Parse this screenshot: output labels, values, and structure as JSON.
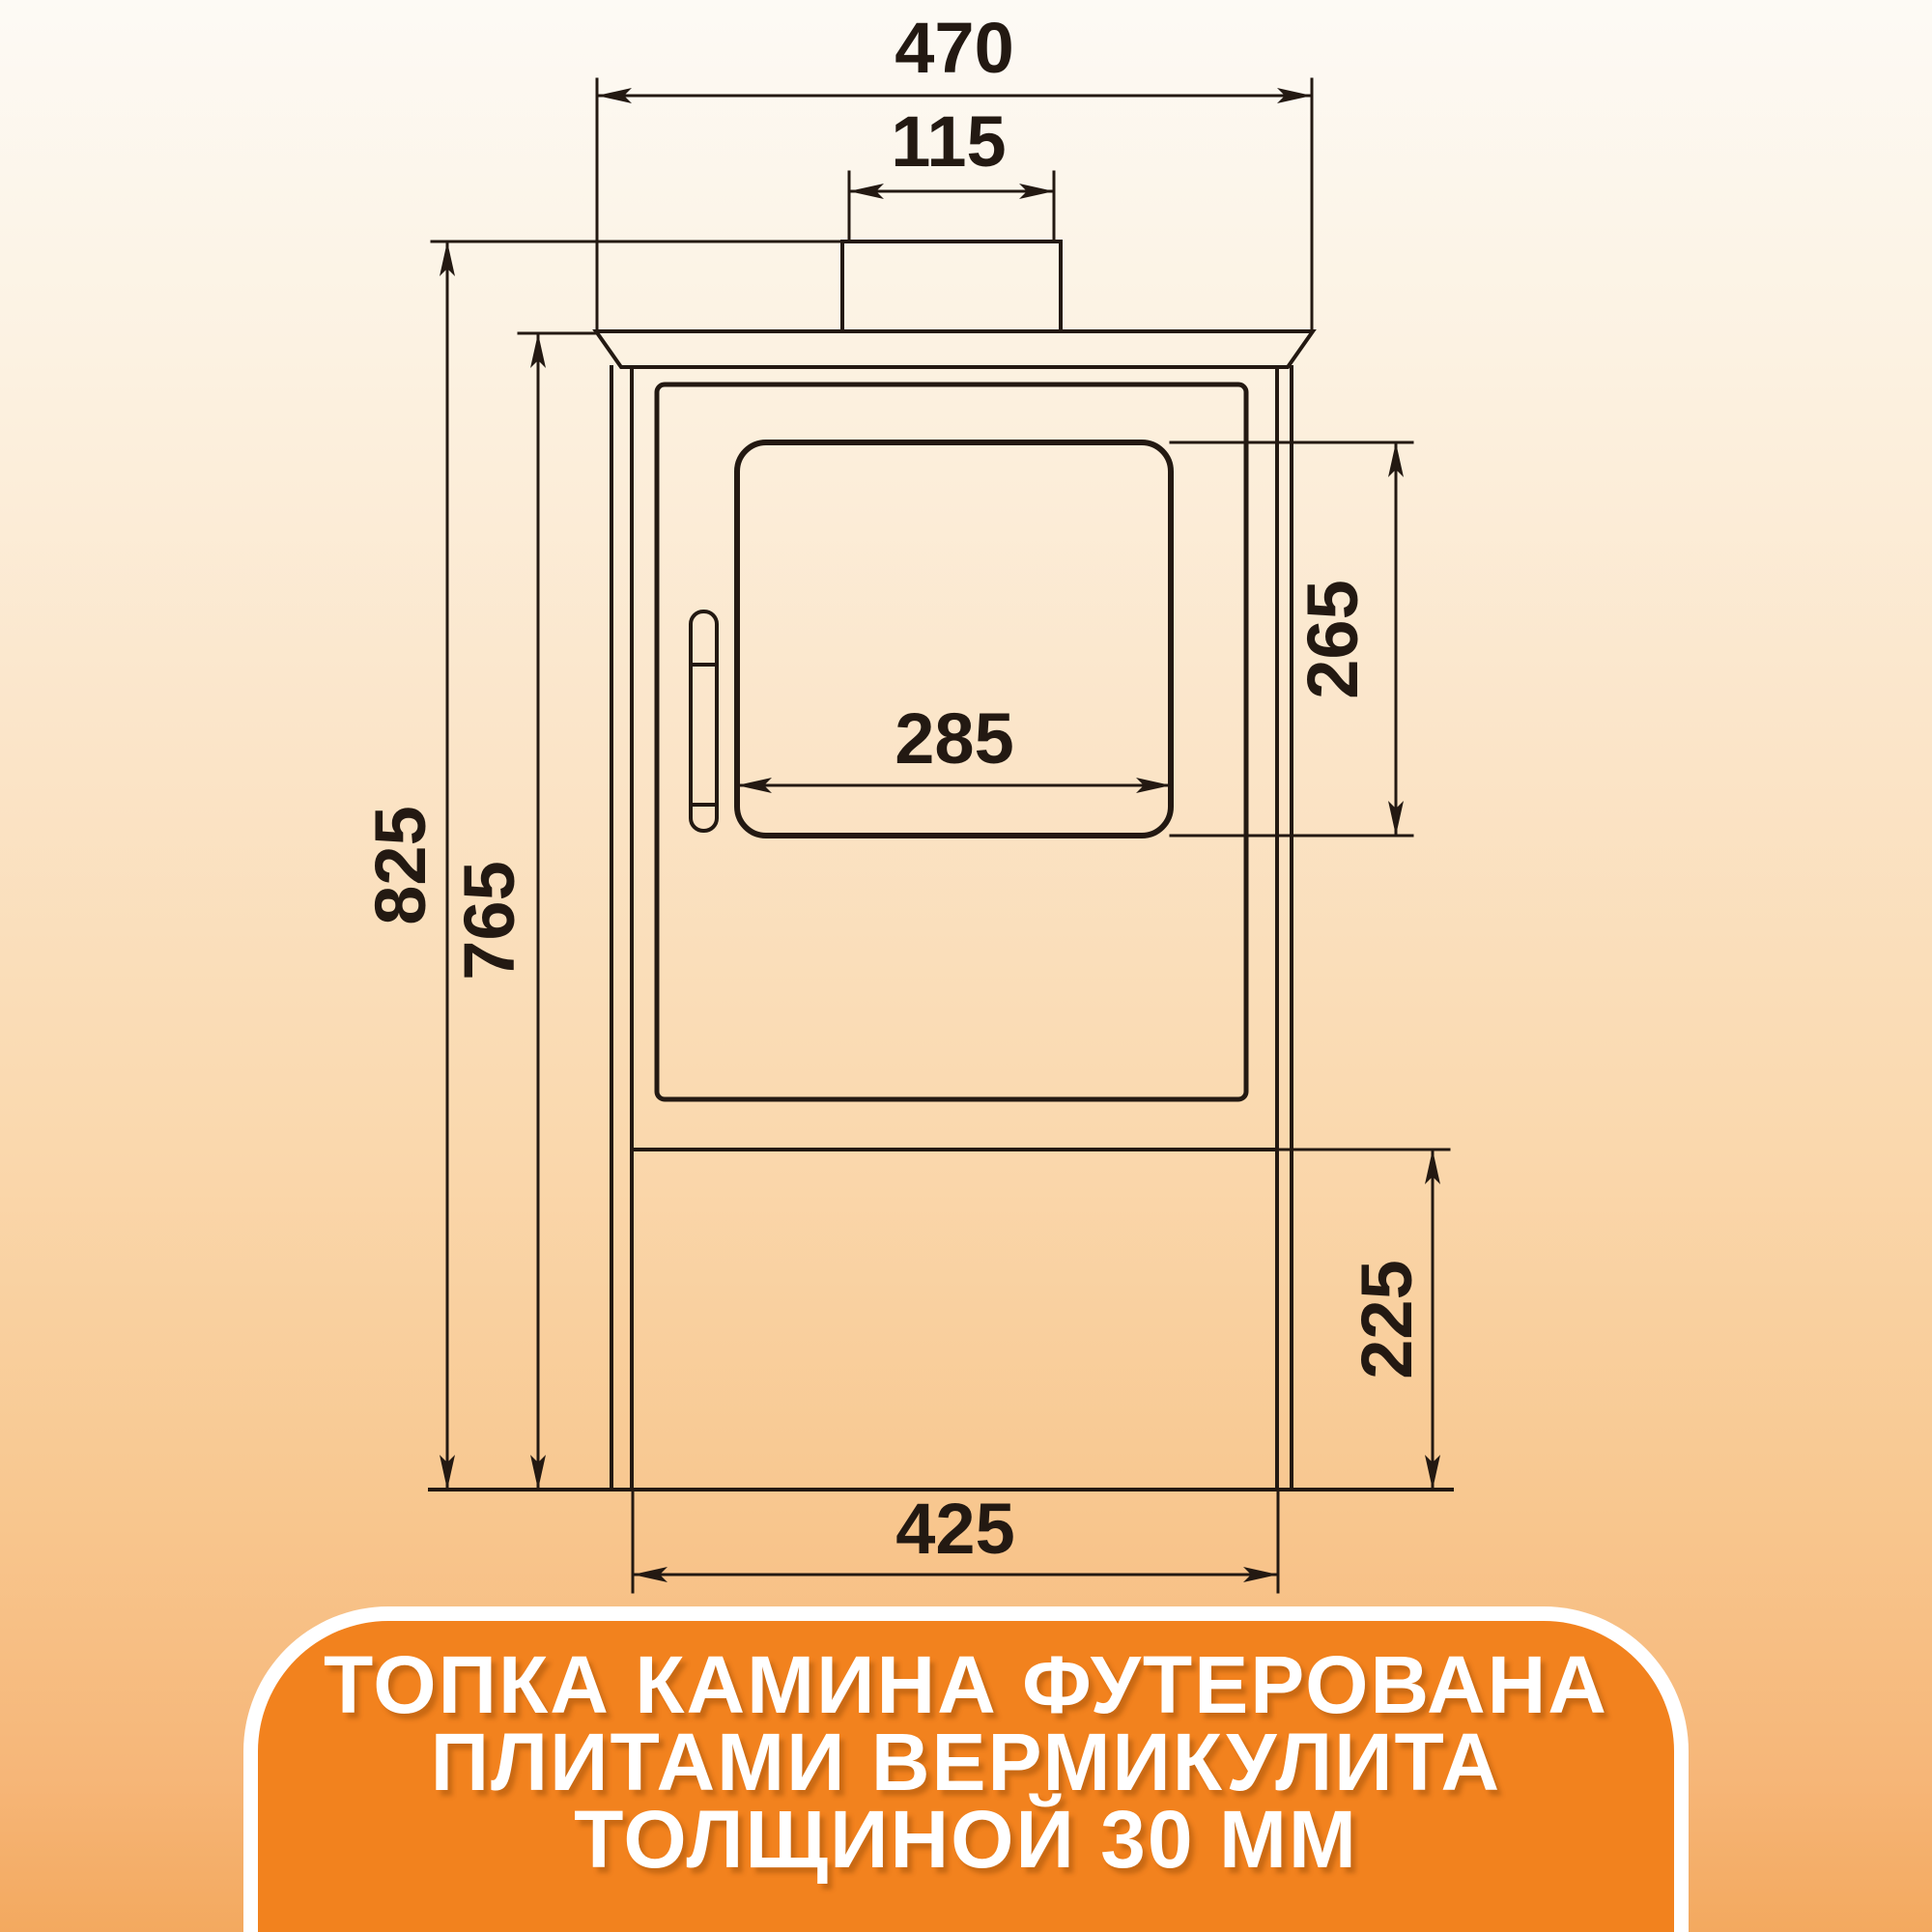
{
  "dimensions": {
    "top_width": "470",
    "flue_width": "115",
    "glass_width": "285",
    "glass_height": "265",
    "total_height": "825",
    "body_height": "765",
    "base_height": "225",
    "base_width": "425"
  },
  "banner": {
    "line1": "ТОПКА КАМИНА ФУТЕРОВАНА",
    "line2": "ПЛИТАМИ ВЕРМИКУЛИТА",
    "line3": "ТОЛЩИНОЙ 30 ММ"
  },
  "colors": {
    "banner_bg": "#F2821E",
    "banner_border": "#FFFFFF",
    "banner_text": "#FFFFFF",
    "line_color": "#231912",
    "background_top": "#FDFAF5",
    "background_bottom": "#F3A95F"
  }
}
